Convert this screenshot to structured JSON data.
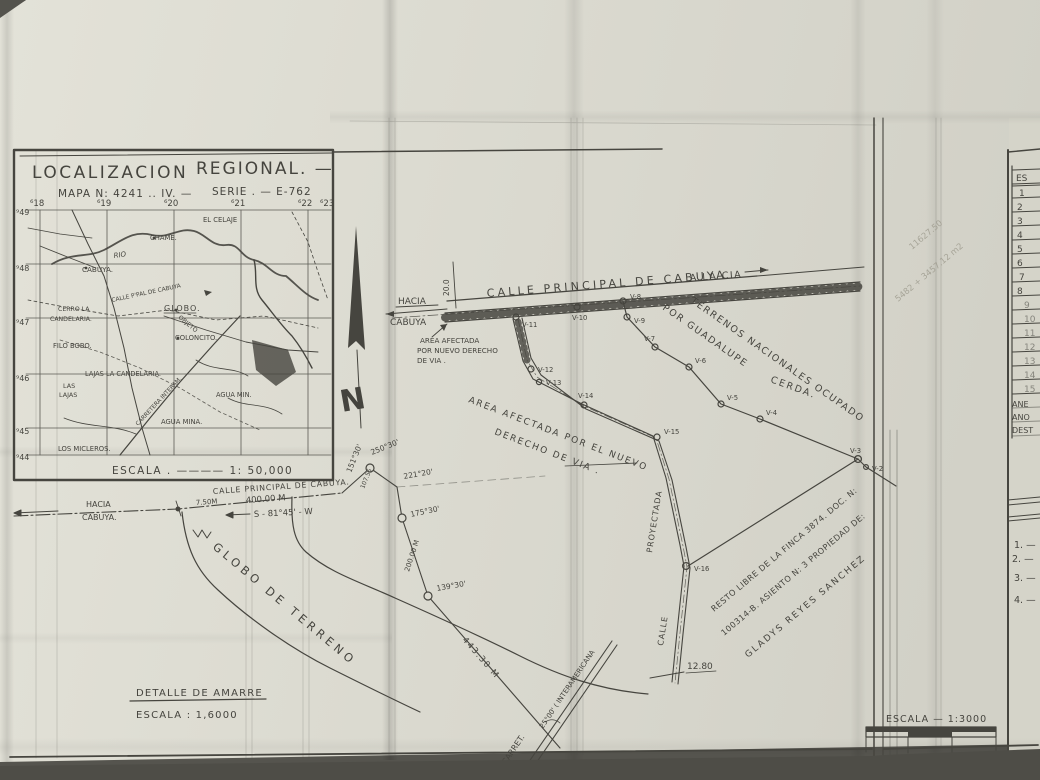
{
  "inset": {
    "title_1": "LOCALIZACION",
    "title_2": "REGIONAL. —",
    "map_line": "MAPA N: 4241 .. IV. —",
    "serie_line": "SERIE . — E-762",
    "grid_top": [
      "⁶18",
      "⁶19",
      "⁶20",
      "⁶21",
      "⁶22",
      "⁶23"
    ],
    "grid_left": [
      "⁹49",
      "⁹48",
      "⁹47",
      "⁹46",
      "⁹45",
      "⁹44"
    ],
    "scale_label": "ESCALA . ———— 1: 50,000",
    "places": {
      "el_celaje": "EL CELAJE",
      "chame": "CHAME.",
      "rio": "RIO",
      "cabuya": "CABUYA.",
      "calle_ppal": "CALLE P'PAL DE CABUYA",
      "globo": "GLOBO.",
      "objeto": "OBJETO",
      "coloncito": "COLONCITO.",
      "cerro_la": "CERRO LA",
      "candelaria": "CANDELARIA.",
      "filo_bobo": "FILO BOBO.",
      "lajas_candelaria": "LAJAS LA CANDELARIA.",
      "las": "LAS",
      "lajas": "LAJAS",
      "agua_mina_1": "AGUA MIN.",
      "agua_mina_2": "AGUA MINA.",
      "los_micleros": "LOS MICLEROS.",
      "carretera_interam": "CARRETERA INTERAM."
    }
  },
  "north": {
    "letter": "N"
  },
  "plan": {
    "road_label": "CALLE PRINCIPAL DE CABUYA",
    "a_la_cia": "A LA CIA",
    "hacia": "HACIA",
    "cabuya": "CABUYA",
    "offset_200": "20.0",
    "apertura_1": "AREA AFECTADA",
    "apertura_2": "POR NUEVO DERECHO",
    "apertura_3": "DE VIA .",
    "afectada_1": "AREA AFECTADA POR EL NUEVO",
    "afectada_2": "DERECHO DE VIA .",
    "terrenos_1": "TERRENOS NACIONALES OCUPADO",
    "terrenos_2": "POR GUADALUPE",
    "terrenos_3": "CERDA.",
    "proyectada": "PROYECTADA",
    "calle": "CALLE",
    "dim_1280": "12.80",
    "resto_1": "RESTO LIBRE DE LA FINCA 3874. DOC. N:",
    "resto_2": "100314-B. ASIENTO N: 3 PROPIEDAD DE:",
    "resto_3": "GLADYS REYES SANCHEZ",
    "pencil_1": "11627.50",
    "pencil_2": "5482 + 3457.12 m2",
    "stations": {
      "v11": "V-11",
      "v10": "V-10",
      "v9": "V-9",
      "v8": "V-8",
      "v7": "V-7",
      "v6": "V-6",
      "v5": "V-5",
      "v4": "V-4",
      "v3": "V-3",
      "v2": "V-2",
      "v12": "V-12",
      "v13": "V-13",
      "v14": "V-14",
      "v15": "V-15",
      "v16": "V-16"
    }
  },
  "detail": {
    "hacia": "HACIA",
    "cabuya": "CABUYA.",
    "road_label": "CALLE PRINCIPAL DE CABUYA.",
    "dist_400": "400.00 M",
    "bearing_s81": "S - 81°45' - W",
    "dist_750": "7.50M",
    "ang_15130": "151°30'",
    "ang_25030": "250°30'",
    "ang_22120": "221°20'",
    "ang_17530": "175°30'",
    "ang_13930": "139°30'",
    "dist_200": "200.00 M",
    "dist_10755": "107.55",
    "globo_de_terreno": "GLOBO DE TERRENO",
    "dist_44330": "443.30 M",
    "ang_2500": "25°00' ( INTERAMERICANA",
    "carret": "CARRET.",
    "title": "DETALLE DE AMARRE",
    "scale": "ESCALA :  1,6000"
  },
  "scalebar": {
    "label": "ESCALA — 1:3000",
    "ticks": [
      "0.",
      "10.",
      "20.",
      "30."
    ]
  },
  "right_sheet": {
    "header": "ES",
    "rows": [
      "1",
      "2",
      "3",
      "4",
      "5",
      "6",
      "7",
      "8",
      "9",
      "10",
      "11",
      "12",
      "13",
      "14",
      "15"
    ],
    "notes": [
      "ANE",
      "ANO",
      "DEST"
    ],
    "items": [
      "1. —",
      "2. —",
      "3. —",
      "4. —"
    ]
  }
}
